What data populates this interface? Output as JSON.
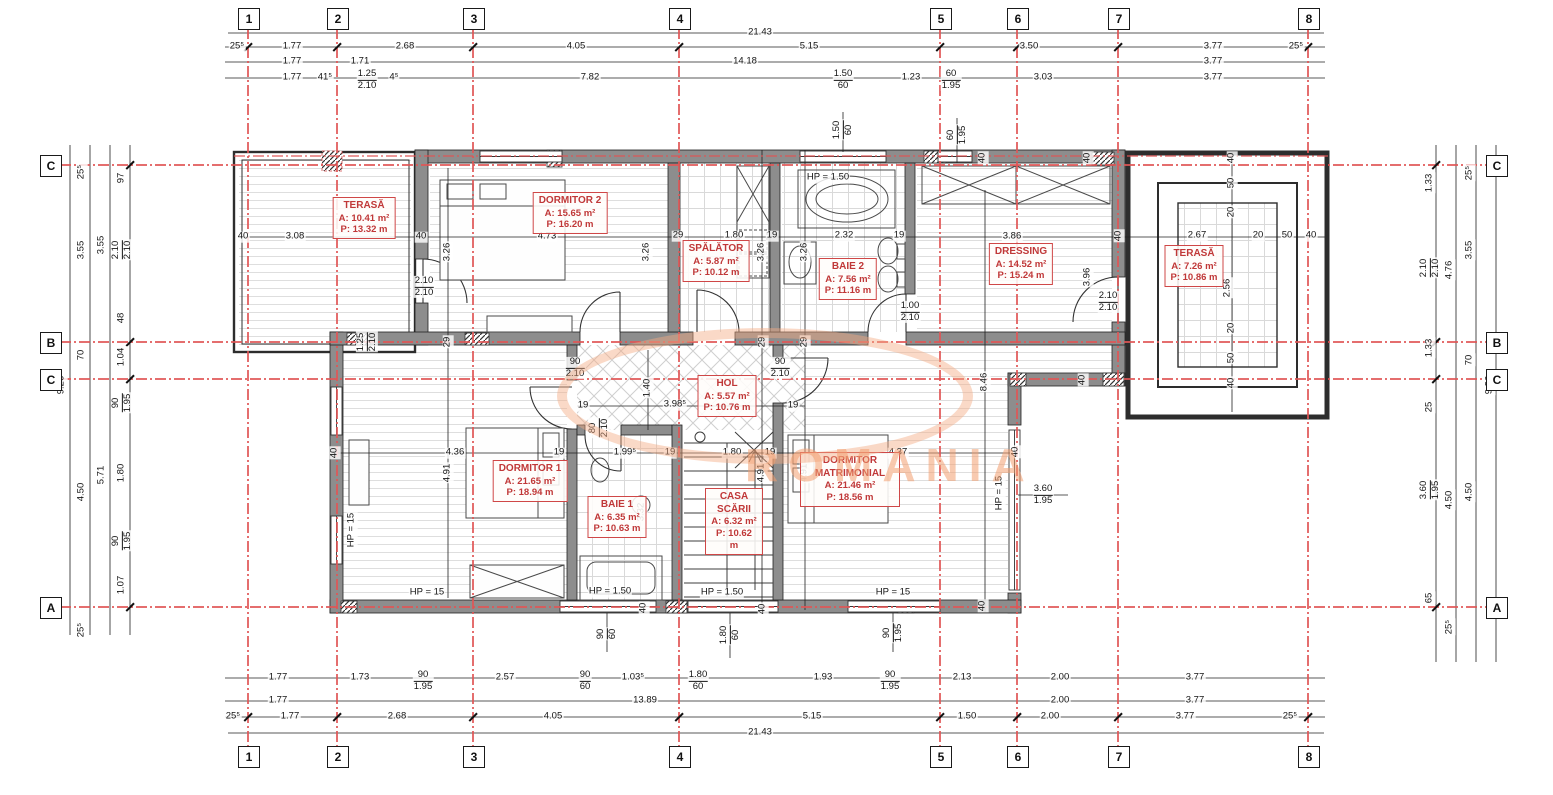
{
  "watermark": {
    "text": "ROMANIA",
    "color": "#f39e70"
  },
  "axes": {
    "vertical": [
      {
        "label": "1",
        "x": 248
      },
      {
        "label": "2",
        "x": 337
      },
      {
        "label": "3",
        "x": 473
      },
      {
        "label": "4",
        "x": 679
      },
      {
        "label": "5",
        "x": 940
      },
      {
        "label": "6",
        "x": 1017
      },
      {
        "label": "7",
        "x": 1118
      },
      {
        "label": "8",
        "x": 1308
      }
    ],
    "horizontal": [
      {
        "label": "C",
        "y": 165
      },
      {
        "label": "B",
        "y": 342
      },
      {
        "label": "C",
        "y": 379
      },
      {
        "label": "A",
        "y": 607
      }
    ]
  },
  "rooms": [
    {
      "id": "terasa-stanga",
      "name": "TERASĂ",
      "a": "A: 10.41 m²",
      "p": "P: 13.32 m",
      "x": 364,
      "y": 197,
      "w": 70
    },
    {
      "id": "dormitor-2",
      "name": "DORMITOR 2",
      "a": "A: 15.65 m²",
      "p": "P: 16.20 m",
      "x": 570,
      "y": 192,
      "w": 76
    },
    {
      "id": "spalator",
      "name": "SPĂLĂTOR",
      "a": "A: 5.87 m²",
      "p": "P: 10.12 m",
      "x": 716,
      "y": 240,
      "w": 66
    },
    {
      "id": "baie-2",
      "name": "BAIE 2",
      "a": "A: 7.56 m²",
      "p": "P: 11.16 m",
      "x": 848,
      "y": 258,
      "w": 60
    },
    {
      "id": "dressing",
      "name": "DRESSING",
      "a": "A: 14.52 m²",
      "p": "P: 15.24 m",
      "x": 1021,
      "y": 243,
      "w": 70
    },
    {
      "id": "terasa-dreapta",
      "name": "TERASĂ",
      "a": "A: 7.26 m²",
      "p": "P: 10.86 m",
      "x": 1194,
      "y": 245,
      "w": 64
    },
    {
      "id": "hol",
      "name": "HOL",
      "a": "A: 5.57 m²",
      "p": "P: 10.76 m",
      "x": 727,
      "y": 375,
      "w": 62
    },
    {
      "id": "dormitor-1",
      "name": "DORMITOR 1",
      "a": "A: 21.65 m²",
      "p": "P: 18.94 m",
      "x": 530,
      "y": 460,
      "w": 78
    },
    {
      "id": "baie-1",
      "name": "BAIE 1",
      "a": "A: 6.35 m²",
      "p": "P: 10.63 m",
      "x": 617,
      "y": 496,
      "w": 56
    },
    {
      "id": "casa-scarii",
      "name": "CASA SCĂRII",
      "a": "A: 6.32 m²",
      "p": "P: 10.62 m",
      "x": 734,
      "y": 488,
      "w": 46
    },
    {
      "id": "dormitor-matrimonial",
      "name": "DORMITOR MATRIMONIAL",
      "a": "A: 21.46 m²",
      "p": "P: 18.56 m",
      "x": 850,
      "y": 452,
      "w": 88
    }
  ],
  "dims": [
    {
      "x": 760,
      "y": 33,
      "t": "21.43"
    },
    {
      "x": 237,
      "y": 47,
      "t": "25⁵"
    },
    {
      "x": 292,
      "y": 47,
      "t": "1.77"
    },
    {
      "x": 405,
      "y": 47,
      "t": "2.68"
    },
    {
      "x": 576,
      "y": 47,
      "t": "4.05"
    },
    {
      "x": 809,
      "y": 47,
      "t": "5.15"
    },
    {
      "x": 1029,
      "y": 47,
      "t": "3.50"
    },
    {
      "x": 1213,
      "y": 47,
      "t": "3.77"
    },
    {
      "x": 1296,
      "y": 47,
      "t": "25⁵"
    },
    {
      "x": 292,
      "y": 62,
      "t": "1.77"
    },
    {
      "x": 360,
      "y": 62,
      "t": "1.71"
    },
    {
      "x": 745,
      "y": 62,
      "t": "14.18"
    },
    {
      "x": 1213,
      "y": 62,
      "t": "3.77"
    },
    {
      "x": 292,
      "y": 78,
      "t": "1.77"
    },
    {
      "x": 325,
      "y": 78,
      "t": "41⁵"
    },
    {
      "x": 367,
      "y": 80,
      "s": [
        "1.25",
        "2.10"
      ]
    },
    {
      "x": 394,
      "y": 78,
      "t": "4⁵"
    },
    {
      "x": 590,
      "y": 78,
      "t": "7.82"
    },
    {
      "x": 843,
      "y": 80,
      "s": [
        "1.50",
        "60"
      ]
    },
    {
      "x": 911,
      "y": 78,
      "t": "1.23"
    },
    {
      "x": 951,
      "y": 80,
      "s": [
        "60",
        "1.95"
      ]
    },
    {
      "x": 1043,
      "y": 78,
      "t": "3.03"
    },
    {
      "x": 1213,
      "y": 78,
      "t": "3.77"
    },
    {
      "x": 278,
      "y": 678,
      "t": "1.77"
    },
    {
      "x": 360,
      "y": 678,
      "t": "1.73"
    },
    {
      "x": 423,
      "y": 681,
      "s": [
        "90",
        "1.95"
      ]
    },
    {
      "x": 505,
      "y": 678,
      "t": "2.57"
    },
    {
      "x": 585,
      "y": 681,
      "s": [
        "90",
        "60"
      ]
    },
    {
      "x": 633,
      "y": 678,
      "t": "1.03⁵"
    },
    {
      "x": 698,
      "y": 681,
      "s": [
        "1.80",
        "60"
      ]
    },
    {
      "x": 823,
      "y": 678,
      "t": "1.93"
    },
    {
      "x": 890,
      "y": 681,
      "s": [
        "90",
        "1.95"
      ]
    },
    {
      "x": 962,
      "y": 678,
      "t": "2.13"
    },
    {
      "x": 1060,
      "y": 678,
      "t": "2.00"
    },
    {
      "x": 1195,
      "y": 678,
      "t": "3.77"
    },
    {
      "x": 278,
      "y": 701,
      "t": "1.77"
    },
    {
      "x": 645,
      "y": 701,
      "t": "13.89"
    },
    {
      "x": 1060,
      "y": 701,
      "t": "2.00"
    },
    {
      "x": 1195,
      "y": 701,
      "t": "3.77"
    },
    {
      "x": 233,
      "y": 717,
      "t": "25⁵"
    },
    {
      "x": 290,
      "y": 717,
      "t": "1.77"
    },
    {
      "x": 397,
      "y": 717,
      "t": "2.68"
    },
    {
      "x": 553,
      "y": 717,
      "t": "4.05"
    },
    {
      "x": 812,
      "y": 717,
      "t": "5.15"
    },
    {
      "x": 967,
      "y": 717,
      "t": "1.50"
    },
    {
      "x": 1050,
      "y": 717,
      "t": "2.00"
    },
    {
      "x": 1185,
      "y": 717,
      "t": "3.77"
    },
    {
      "x": 1290,
      "y": 717,
      "t": "25⁵"
    },
    {
      "x": 760,
      "y": 733,
      "t": "21.43"
    },
    {
      "x": 62,
      "y": 385,
      "t": "9.26",
      "r": 1
    },
    {
      "x": 82,
      "y": 172,
      "t": "25⁵",
      "r": 1
    },
    {
      "x": 82,
      "y": 250,
      "t": "3.55",
      "r": 1
    },
    {
      "x": 82,
      "y": 355,
      "t": "70",
      "r": 1
    },
    {
      "x": 82,
      "y": 492,
      "t": "4.50",
      "r": 1
    },
    {
      "x": 82,
      "y": 630,
      "t": "25⁵",
      "r": 1
    },
    {
      "x": 102,
      "y": 245,
      "t": "3.55",
      "r": 1
    },
    {
      "x": 102,
      "y": 475,
      "t": "5.71",
      "r": 1
    },
    {
      "x": 122,
      "y": 178,
      "t": "97",
      "r": 1
    },
    {
      "x": 122,
      "y": 250,
      "s": [
        "2.10",
        "2.10"
      ],
      "r": 1
    },
    {
      "x": 122,
      "y": 318,
      "t": "48",
      "r": 1
    },
    {
      "x": 122,
      "y": 357,
      "t": "1.04",
      "r": 1
    },
    {
      "x": 122,
      "y": 403,
      "s": [
        "90",
        "1.95"
      ],
      "r": 1
    },
    {
      "x": 122,
      "y": 473,
      "t": "1.80",
      "r": 1
    },
    {
      "x": 122,
      "y": 541,
      "s": [
        "90",
        "1.95"
      ],
      "r": 1
    },
    {
      "x": 122,
      "y": 585,
      "t": "1.07",
      "r": 1
    },
    {
      "x": 1430,
      "y": 183,
      "t": "1.33",
      "r": 1
    },
    {
      "x": 1430,
      "y": 268,
      "s": [
        "2.10",
        "2.10"
      ],
      "r": 1
    },
    {
      "x": 1430,
      "y": 348,
      "t": "1.33",
      "r": 1
    },
    {
      "x": 1430,
      "y": 407,
      "t": "25",
      "r": 1
    },
    {
      "x": 1430,
      "y": 490,
      "s": [
        "3.60",
        "1.95"
      ],
      "r": 1
    },
    {
      "x": 1430,
      "y": 598,
      "t": "65",
      "r": 1
    },
    {
      "x": 1450,
      "y": 270,
      "t": "4.76",
      "r": 1
    },
    {
      "x": 1450,
      "y": 500,
      "t": "4.50",
      "r": 1
    },
    {
      "x": 1450,
      "y": 627,
      "t": "25⁵",
      "r": 1
    },
    {
      "x": 1470,
      "y": 173,
      "t": "25⁵",
      "r": 1
    },
    {
      "x": 1470,
      "y": 250,
      "t": "3.55",
      "r": 1
    },
    {
      "x": 1470,
      "y": 360,
      "t": "70",
      "r": 1
    },
    {
      "x": 1470,
      "y": 492,
      "t": "4.50",
      "r": 1
    },
    {
      "x": 1490,
      "y": 385,
      "t": "9.26",
      "r": 1
    },
    {
      "x": 243,
      "y": 237,
      "t": "40"
    },
    {
      "x": 295,
      "y": 237,
      "t": "3.08"
    },
    {
      "x": 421,
      "y": 237,
      "t": "40"
    },
    {
      "x": 547,
      "y": 237,
      "t": "4.73"
    },
    {
      "x": 678,
      "y": 236,
      "t": "29"
    },
    {
      "x": 734,
      "y": 236,
      "t": "1.80"
    },
    {
      "x": 772,
      "y": 236,
      "t": "19"
    },
    {
      "x": 844,
      "y": 236,
      "t": "2.32"
    },
    {
      "x": 899,
      "y": 236,
      "t": "19"
    },
    {
      "x": 1012,
      "y": 237,
      "t": "3.86"
    },
    {
      "x": 1119,
      "y": 236,
      "t": "40",
      "r": 1
    },
    {
      "x": 1197,
      "y": 236,
      "t": "2.67"
    },
    {
      "x": 1258,
      "y": 236,
      "t": "20"
    },
    {
      "x": 1287,
      "y": 236,
      "t": "50"
    },
    {
      "x": 1311,
      "y": 236,
      "t": "40"
    },
    {
      "x": 448,
      "y": 252,
      "t": "3.26",
      "r": 1
    },
    {
      "x": 647,
      "y": 252,
      "t": "3.26",
      "r": 1
    },
    {
      "x": 762,
      "y": 252,
      "t": "3.26",
      "r": 1
    },
    {
      "x": 805,
      "y": 252,
      "t": "3.26",
      "r": 1
    },
    {
      "x": 1088,
      "y": 277,
      "t": "3.96",
      "r": 1
    },
    {
      "x": 1228,
      "y": 288,
      "t": "2.56",
      "r": 1
    },
    {
      "x": 1232,
      "y": 158,
      "t": "40",
      "r": 1
    },
    {
      "x": 1232,
      "y": 183,
      "t": "50",
      "r": 1
    },
    {
      "x": 1232,
      "y": 212,
      "t": "20",
      "r": 1
    },
    {
      "x": 1232,
      "y": 328,
      "t": "20",
      "r": 1
    },
    {
      "x": 1232,
      "y": 358,
      "t": "50",
      "r": 1
    },
    {
      "x": 1232,
      "y": 383,
      "t": "40",
      "r": 1
    },
    {
      "x": 843,
      "y": 130,
      "s": [
        "1.50",
        "60"
      ],
      "r": 1
    },
    {
      "x": 957,
      "y": 135,
      "s": [
        "60",
        "1.95"
      ],
      "r": 1
    },
    {
      "x": 983,
      "y": 158,
      "t": "40",
      "r": 1
    },
    {
      "x": 1088,
      "y": 158,
      "t": "40",
      "r": 1
    },
    {
      "x": 985,
      "y": 382,
      "t": "8.46",
      "r": 1
    },
    {
      "x": 1083,
      "y": 380,
      "t": "40",
      "r": 1
    },
    {
      "x": 1016,
      "y": 452,
      "t": "40",
      "r": 1
    },
    {
      "x": 983,
      "y": 606,
      "t": "40",
      "r": 1
    },
    {
      "x": 1000,
      "y": 493,
      "t": "HP = 15",
      "r": 1
    },
    {
      "x": 1043,
      "y": 495,
      "s": [
        "3.60",
        "1.95"
      ]
    },
    {
      "x": 575,
      "y": 368,
      "s": [
        "90",
        "2.10"
      ]
    },
    {
      "x": 780,
      "y": 368,
      "s": [
        "90",
        "2.10"
      ]
    },
    {
      "x": 648,
      "y": 388,
      "t": "1.40",
      "r": 1
    },
    {
      "x": 675,
      "y": 405,
      "t": "3.98⁵"
    },
    {
      "x": 583,
      "y": 406,
      "t": "19"
    },
    {
      "x": 793,
      "y": 406,
      "t": "19"
    },
    {
      "x": 599,
      "y": 428,
      "s": [
        "80",
        "2.10"
      ],
      "r": 1
    },
    {
      "x": 625,
      "y": 453,
      "t": "1.99⁵"
    },
    {
      "x": 335,
      "y": 453,
      "t": "40",
      "r": 1
    },
    {
      "x": 455,
      "y": 453,
      "t": "4.36"
    },
    {
      "x": 559,
      "y": 453,
      "t": "19"
    },
    {
      "x": 670,
      "y": 453,
      "t": "19"
    },
    {
      "x": 732,
      "y": 453,
      "t": "1.80"
    },
    {
      "x": 770,
      "y": 453,
      "t": "19"
    },
    {
      "x": 898,
      "y": 453,
      "t": "4.37"
    },
    {
      "x": 448,
      "y": 473,
      "t": "4.91",
      "r": 1
    },
    {
      "x": 762,
      "y": 473,
      "t": "4.91",
      "r": 1
    },
    {
      "x": 805,
      "y": 473,
      "t": "4.91",
      "r": 1
    },
    {
      "x": 642,
      "y": 512,
      "t": "3.32",
      "r": 1
    },
    {
      "x": 352,
      "y": 530,
      "t": "HP = 15",
      "r": 1
    },
    {
      "x": 427,
      "y": 593,
      "t": "HP = 15"
    },
    {
      "x": 610,
      "y": 592,
      "t": "HP = 1.50"
    },
    {
      "x": 722,
      "y": 593,
      "t": "HP = 1.50"
    },
    {
      "x": 893,
      "y": 593,
      "t": "HP = 15"
    },
    {
      "x": 607,
      "y": 634,
      "s": [
        "90",
        "60"
      ],
      "r": 1
    },
    {
      "x": 730,
      "y": 635,
      "s": [
        "1.80",
        "60"
      ],
      "r": 1
    },
    {
      "x": 893,
      "y": 633,
      "s": [
        "90",
        "1.95"
      ],
      "r": 1
    },
    {
      "x": 644,
      "y": 608,
      "t": "40",
      "r": 1
    },
    {
      "x": 763,
      "y": 609,
      "t": "40",
      "r": 1
    },
    {
      "x": 424,
      "y": 287,
      "s": [
        "2.10",
        "2.10"
      ]
    },
    {
      "x": 367,
      "y": 342,
      "s": [
        "1.25",
        "2.10"
      ],
      "r": 1
    },
    {
      "x": 448,
      "y": 342,
      "t": "29",
      "r": 1
    },
    {
      "x": 763,
      "y": 342,
      "t": "29",
      "r": 1
    },
    {
      "x": 805,
      "y": 342,
      "t": "29",
      "r": 1
    },
    {
      "x": 828,
      "y": 178,
      "t": "HP = 1.50"
    },
    {
      "x": 910,
      "y": 312,
      "s": [
        "1.00",
        "2.10"
      ]
    },
    {
      "x": 1108,
      "y": 302,
      "s": [
        "2.10",
        "2.10"
      ]
    }
  ]
}
